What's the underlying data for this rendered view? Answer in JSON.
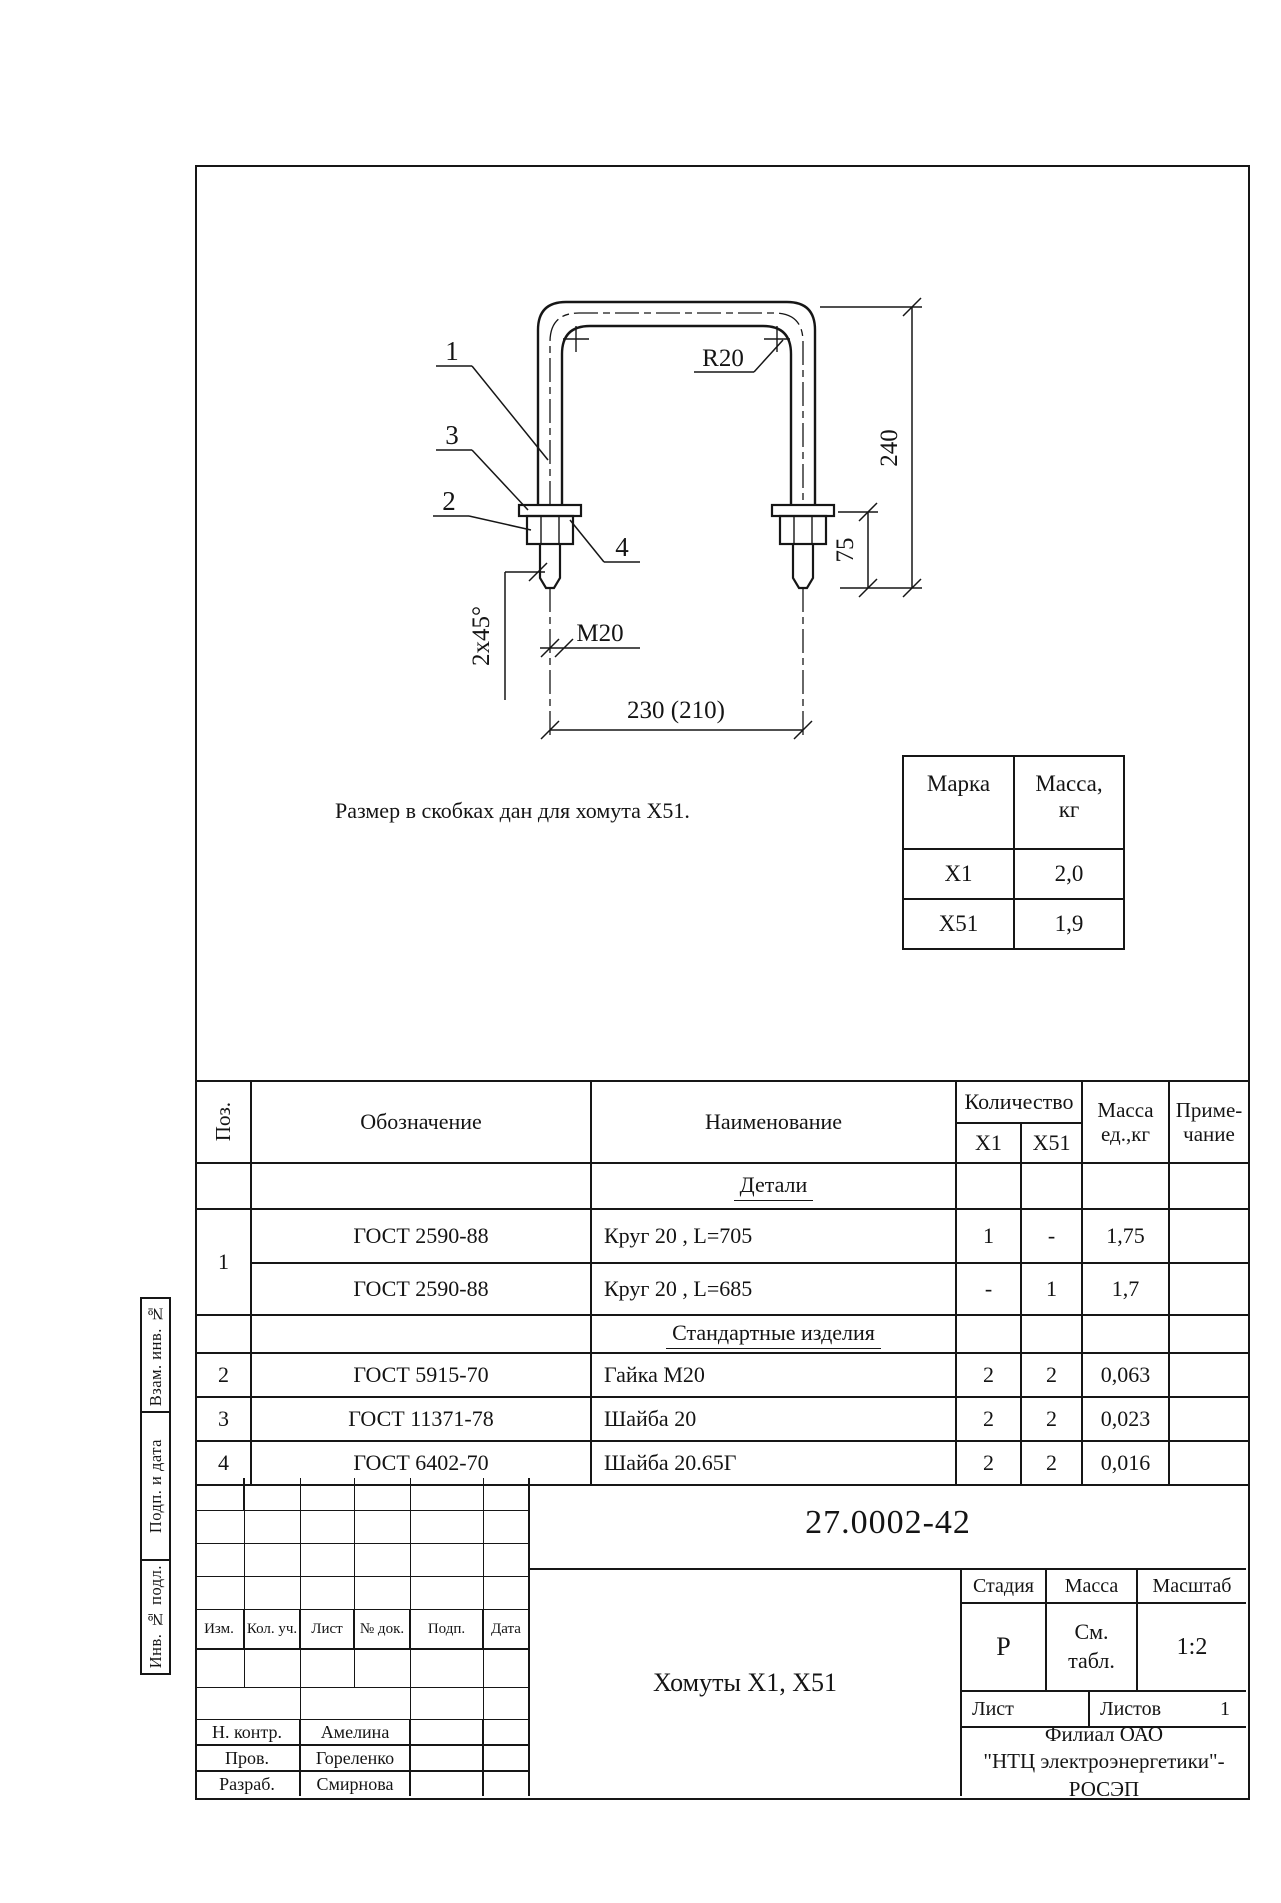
{
  "drawing": {
    "callout_1": "1",
    "callout_2": "2",
    "callout_3": "3",
    "callout_4": "4",
    "dim_radius": "R20",
    "dim_height": "240",
    "dim_thread_len": "75",
    "dim_thread": "М20",
    "dim_chamfer": "2х45°",
    "dim_width": "230 (210)",
    "note": "Размер в скобках дан для хомута Х51."
  },
  "mass_table": {
    "col_mark": "Марка",
    "col_mass_1": "Масса,",
    "col_mass_2": "кг",
    "rows": [
      {
        "mark": "Х1",
        "mass": "2,0"
      },
      {
        "mark": "Х51",
        "mass": "1,9"
      }
    ]
  },
  "parts_table": {
    "headers": {
      "pos": "Поз.",
      "designation": "Обозначение",
      "name": "Наименование",
      "qty": "Количество",
      "qty_x1": "Х1",
      "qty_x51": "Х51",
      "mass_1": "Масса",
      "mass_2": "ед.,кг",
      "note_1": "Приме-",
      "note_2": "чание"
    },
    "section_details": "Детали",
    "section_standard": "Стандартные изделия",
    "rows": [
      {
        "pos": "1",
        "designation": "ГОСТ 2590-88",
        "name": "Круг 20 , L=705",
        "x1": "1",
        "x51": "-",
        "mass": "1,75"
      },
      {
        "designation": "ГОСТ 2590-88",
        "name": "Круг 20 , L=685",
        "x1": "-",
        "x51": "1",
        "mass": "1,7"
      },
      {
        "pos": "2",
        "designation": "ГОСТ 5915-70",
        "name": "Гайка М20",
        "x1": "2",
        "x51": "2",
        "mass": "0,063"
      },
      {
        "pos": "3",
        "designation": "ГОСТ 11371-78",
        "name": "Шайба 20",
        "x1": "2",
        "x51": "2",
        "mass": "0,023"
      },
      {
        "pos": "4",
        "designation": "ГОСТ 6402-70",
        "name": "Шайба 20.65Г",
        "x1": "2",
        "x51": "2",
        "mass": "0,016"
      }
    ]
  },
  "title_block": {
    "doc_number": "27.0002-42",
    "title": "Хомуты Х1, Х51",
    "stage_label": "Стадия",
    "mass_label": "Масса",
    "scale_label": "Масштаб",
    "stage_value": "Р",
    "mass_value_1": "См.",
    "mass_value_2": "табл.",
    "scale_value": "1:2",
    "sheet_label": "Лист",
    "sheets_label": "Листов",
    "sheets_value": "1",
    "org_line1": "Филиал ОАО",
    "org_line2": "\"НТЦ электроэнергетики\"-",
    "org_line3": "РОСЭП",
    "rev_headers": [
      "Изм.",
      "Кол. уч.",
      "Лист",
      "№ док.",
      "Подп.",
      "Дата"
    ],
    "signatures": [
      {
        "role": "Н. контр.",
        "name": "Амелина"
      },
      {
        "role": "Пров.",
        "name": "Гореленко"
      },
      {
        "role": "Разраб.",
        "name": "Смирнова"
      }
    ]
  },
  "sidebar": {
    "labels": [
      "Взам. инв. №",
      "Подп. и дата",
      "Инв. № подл."
    ]
  }
}
